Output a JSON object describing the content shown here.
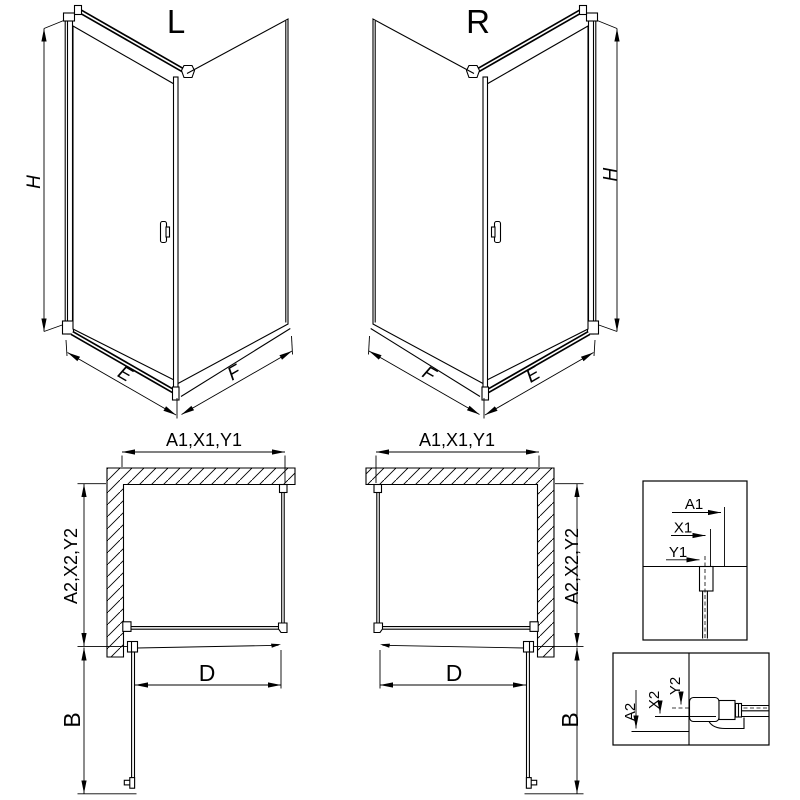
{
  "drawing": {
    "front_views": {
      "left": {
        "title": "L",
        "height_label": "H",
        "door_width_label": "E",
        "side_width_label": "F"
      },
      "right": {
        "title": "R",
        "height_label": "H",
        "door_width_label": "E",
        "side_width_label": "F"
      }
    },
    "plan_views": {
      "left": {
        "width_label": "A1,X1,Y1",
        "depth_label": "A2,X2,Y2",
        "door_label": "D",
        "swing_label": "B"
      },
      "right": {
        "width_label": "A1,X1,Y1",
        "depth_label": "A2,X2,Y2",
        "door_label": "D",
        "swing_label": "B"
      }
    },
    "detail_views": {
      "width_detail": {
        "outer": "A1",
        "middle": "X1",
        "axis": "Y1"
      },
      "depth_detail": {
        "outer": "A2",
        "middle": "X2",
        "axis": "Y2"
      }
    },
    "colors": {
      "line": "#000000",
      "background": "#ffffff"
    }
  }
}
